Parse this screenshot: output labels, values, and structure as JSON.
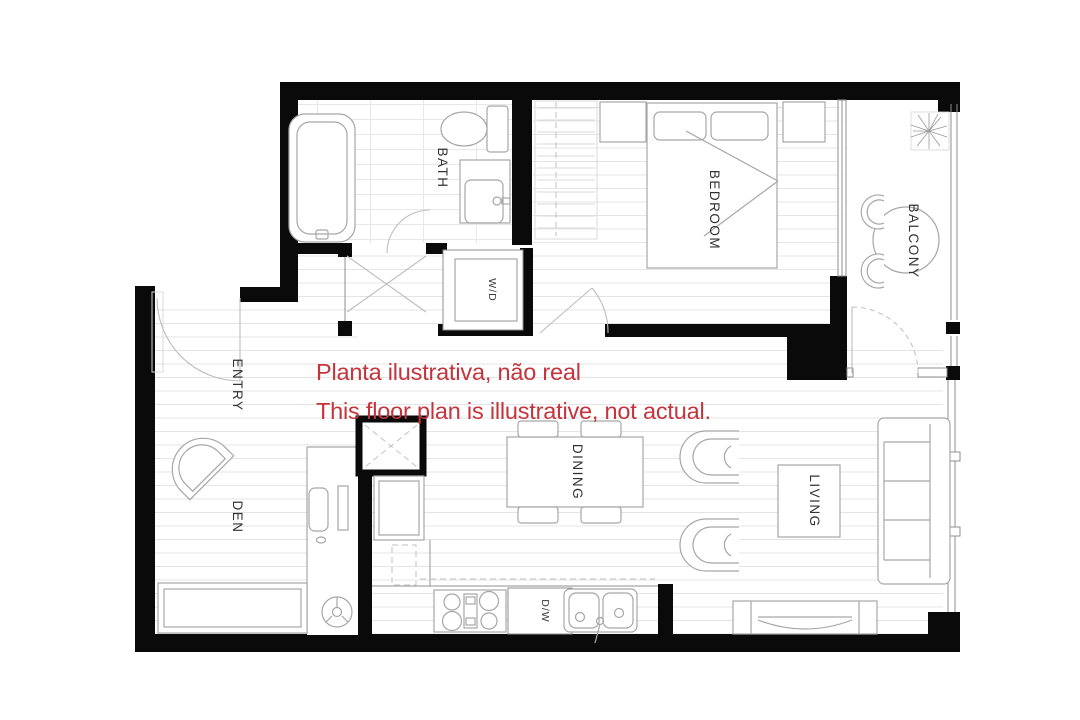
{
  "disclaimer": {
    "line1": "Planta ilustrativa, não real",
    "line2": "This floor plan is illustrative, not actual.",
    "color": "#c5343c"
  },
  "rooms": {
    "bath": "BATH",
    "bedroom": "BEDROOM",
    "balcony": "BALCONY",
    "entry": "ENTRY",
    "den": "DEN",
    "dining": "DINING",
    "living": "LIVING"
  },
  "appliances": {
    "washer_dryer": "W/D",
    "dishwasher": "D/W"
  },
  "colors": {
    "wall": "#0a0a0a",
    "label": "#323232",
    "floor_line": "#e4e4e4",
    "fixture_line": "#a6a6a6"
  }
}
